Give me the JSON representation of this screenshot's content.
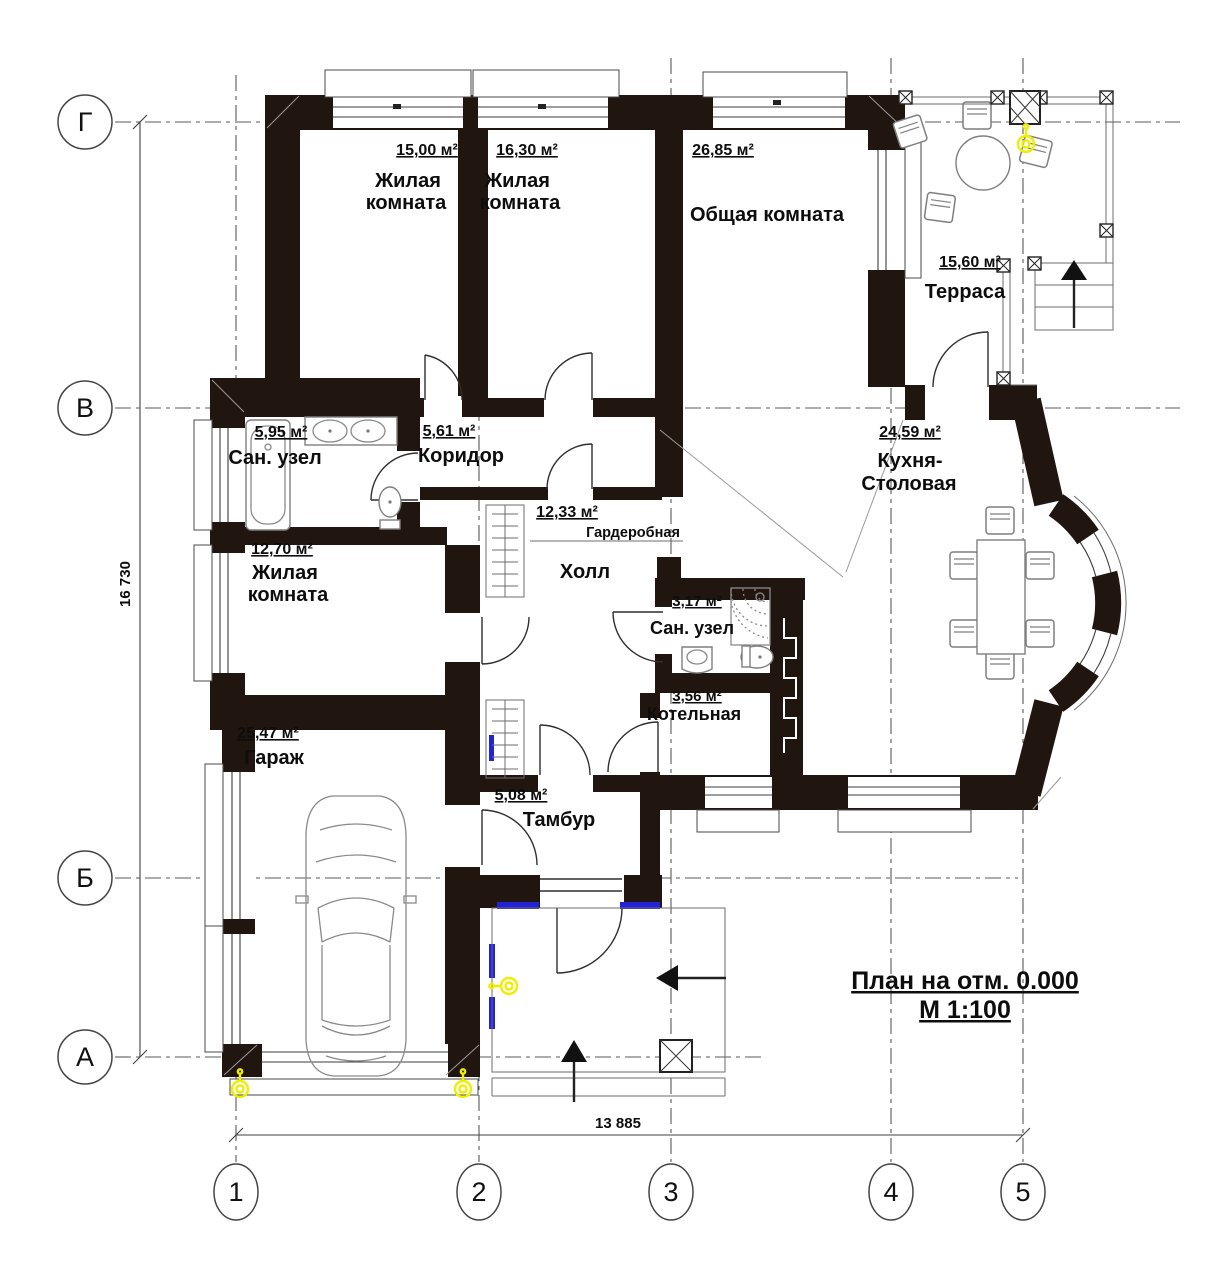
{
  "drawing": {
    "title_line1": "План на отм. 0.000",
    "title_line2": "М 1:100",
    "dim_vertical": "16 730",
    "dim_horizontal": "13 885"
  },
  "axes": {
    "rows": [
      "Г",
      "В",
      "Б",
      "А"
    ],
    "cols": [
      "1",
      "2",
      "3",
      "4",
      "5"
    ]
  },
  "rooms": {
    "living1": {
      "area": "15,00 м²",
      "name1": "Жилая",
      "name2": "комната"
    },
    "living2": {
      "area": "16,30 м²",
      "name1": "Жилая",
      "name2": "комната"
    },
    "common": {
      "area": "26,85 м²",
      "name1": "Общая комната"
    },
    "terrace": {
      "area": "15,60 м²",
      "name1": "Терраса"
    },
    "bath1": {
      "area": "5,95 м²",
      "name1": "Сан. узел"
    },
    "corridor": {
      "area": "5,61 м²",
      "name1": "Коридор"
    },
    "living3": {
      "area": "12,70 м²",
      "name1": "Жилая",
      "name2": "комната"
    },
    "hall": {
      "area": "12,33 м²",
      "name1": "Холл",
      "closet": "Гардеробная"
    },
    "bath2": {
      "area": "3,17 м²",
      "name1": "Сан. узел"
    },
    "boiler": {
      "area": "3,56 м²",
      "name1": "Котельная"
    },
    "garage": {
      "area": "25,47 м²",
      "name1": "Гараж"
    },
    "tambour": {
      "area": "5,08 м²",
      "name1": "Тамбур"
    },
    "kitchen": {
      "area": "24,59 м²",
      "name1": "Кухня-",
      "name2": "Столовая"
    }
  },
  "colors": {
    "wall": "#20160f",
    "lamp_accent": "#f0ee00",
    "window_accent": "#2323d6"
  }
}
